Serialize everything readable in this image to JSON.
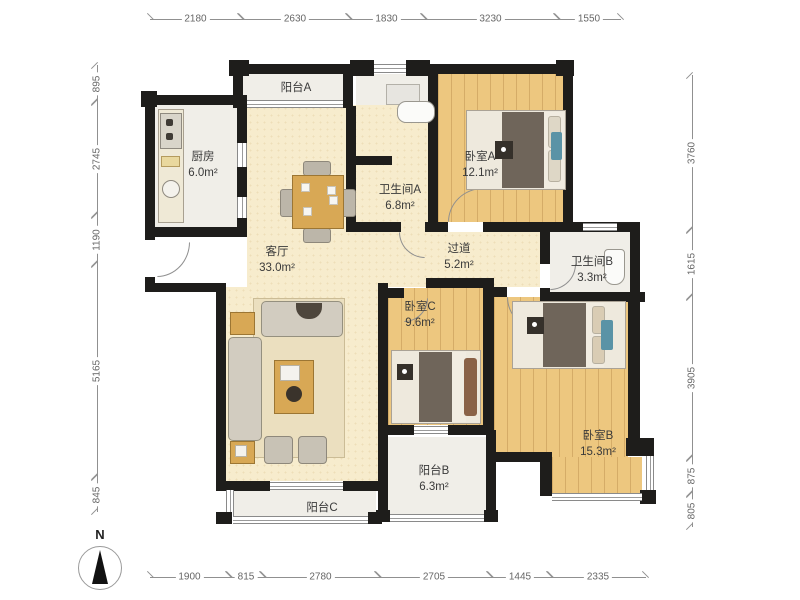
{
  "plan_type": "apartment-floor-plan",
  "compass": {
    "label": "N"
  },
  "rooms": {
    "balcony_a": {
      "name": "阳台A",
      "area": ""
    },
    "kitchen": {
      "name": "厨房",
      "area": "6.0m²"
    },
    "bath_a": {
      "name": "卫生间A",
      "area": "6.8m²"
    },
    "bed_a": {
      "name": "卧室A",
      "area": "12.1m²"
    },
    "living": {
      "name": "客厅",
      "area": "33.0m²"
    },
    "hall": {
      "name": "过道",
      "area": "5.2m²"
    },
    "bath_b": {
      "name": "卫生间B",
      "area": "3.3m²"
    },
    "bed_c": {
      "name": "卧室C",
      "area": "9.6m²"
    },
    "bed_b": {
      "name": "卧室B",
      "area": "15.3m²"
    },
    "balcony_b": {
      "name": "阳台B",
      "area": "6.3m²"
    },
    "balcony_c": {
      "name": "阳台C",
      "area": ""
    }
  },
  "dimensions": {
    "top": [
      "2180",
      "2630",
      "1830",
      "3230",
      "1550"
    ],
    "bottom": [
      "1900",
      "815",
      "2780",
      "2705",
      "1445",
      "2335"
    ],
    "left": [
      "895",
      "2745",
      "1190",
      "5165",
      "845"
    ],
    "right": [
      "3760",
      "1615",
      "3905",
      "875",
      "805"
    ]
  },
  "colors": {
    "wall": "#1e1d1b",
    "wood_floor": "#edc77f",
    "living_floor": "#f7eccd",
    "wet_floor": "#f0eee8",
    "table_wood": "#d8a855",
    "dim_line": "#909090"
  }
}
